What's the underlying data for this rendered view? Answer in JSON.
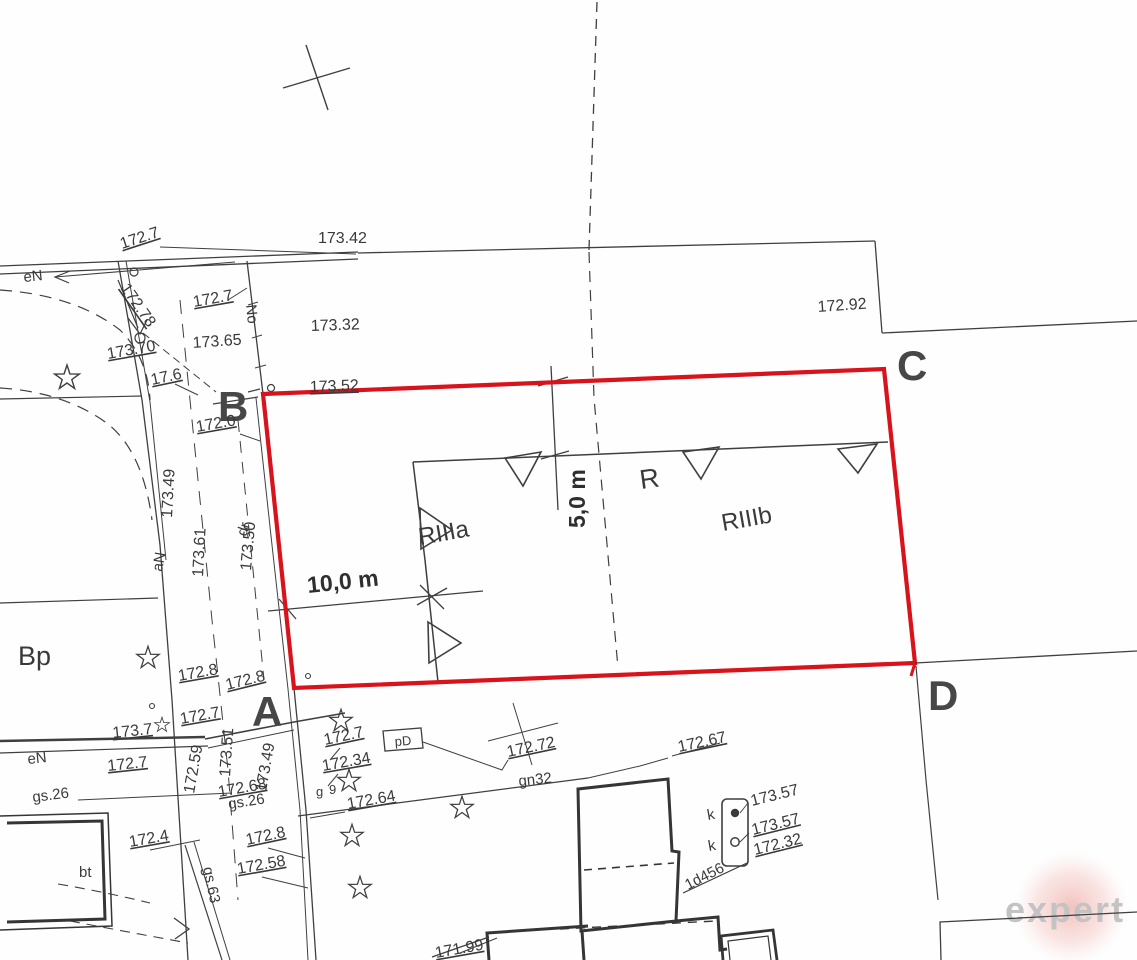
{
  "map": {
    "colors": {
      "parcel_outline_red": "#d8131b",
      "map_ink": "#3a3a3a",
      "watermark_gray": "#c3c3c3",
      "watermark_glow": "#e98f88"
    },
    "points": {
      "a": "A",
      "b": "B",
      "c": "C",
      "d": "D"
    },
    "dimensions": {
      "horizontal": "10,0 m",
      "vertical": "5,0 m"
    },
    "land_use": {
      "bp": "Bp",
      "riiia": "RIIIa",
      "riiib": "RIIIb",
      "r": "R",
      "bt": "bt",
      "dr": "dr"
    },
    "utility_labels": {
      "en_top": "eN",
      "en_bottom": "eN",
      "no_vertical": "No",
      "an": "aN",
      "gs26_left": "gs.26",
      "gs26_right": "gs.26",
      "gs63": "gs.63",
      "gn32": "gn32",
      "pd": "pD",
      "k_top": "k",
      "k_bottom": "k",
      "id456": "1d456",
      "g": "g",
      "nine": "9"
    },
    "spot_heights": {
      "h172_7_top": "172.7",
      "h173_42": "173.42",
      "h172_78": "172.78",
      "h172_7_b": "172.7",
      "h173_65": "173.65",
      "h173_32": "173.32",
      "h173_70": "173.70",
      "h17_6": "17.6",
      "h173_52": "173.52",
      "h172_92": "172.92",
      "h172_0": "172.0",
      "h173_49_road": "173.49",
      "h173_61": "173.61",
      "h173_50": "173.50",
      "h172_8_a1": "172.8",
      "h172_8_a2": "172.8",
      "h173_7_left": "173.7",
      "h172_7_left1": "172.7",
      "h172_7_left2": "172.7",
      "h172_59": "172.59",
      "h173_51": "173.51",
      "h173_49_a": "173.49",
      "h172_68": "172.68",
      "h172_64": "172.64",
      "h172_7_right": "172.7",
      "h172_34": "172.34",
      "h172_72": "172.72",
      "h172_67": "172.67",
      "h172_4": "172.4",
      "h172_8_low": "172.8",
      "h172_58": "172.58",
      "h171_99": "171.99",
      "h173_57_a": "173.57",
      "h173_57_b": "173.57",
      "h172_32": "172.32"
    },
    "watermark": "expert"
  }
}
